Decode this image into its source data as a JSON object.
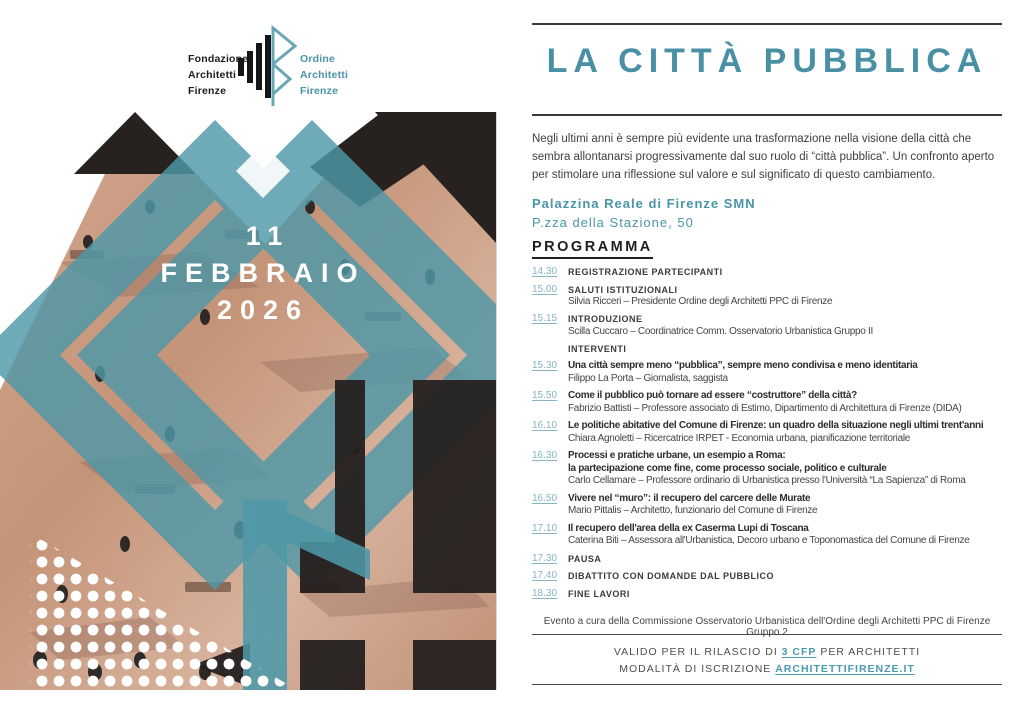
{
  "logos": {
    "fondazione": "Fondazione\nArchitetti\nFirenze",
    "ordine": "Ordine\nArchitetti\nFirenze"
  },
  "poster": {
    "date_line1": "11",
    "date_line2": "FEBBRAIO",
    "date_line3": "2026"
  },
  "header": {
    "title": "LA CITTÀ PUBBLICA"
  },
  "intro": "Negli ultimi anni è sempre più evidente una trasformazione nella visione della città che sembra allontanarsi progressivamente dal suo ruolo di “città pubblica”. Un confronto aperto per stimolare una riflessione sul valore e sul significato di questo cambiamento.",
  "venue": {
    "name": "Palazzina Reale di Firenze SMN",
    "address": "P.zza della Stazione, 50"
  },
  "program": {
    "heading": "PROGRAMMA",
    "items": [
      {
        "time": "14.30",
        "title": "REGISTRAZIONE PARTECIPANTI"
      },
      {
        "time": "15.00",
        "title": "SALUTI ISTITUZIONALI",
        "speaker": "Silvia Ricceri – Presidente Ordine degli Architetti PPC di Firenze"
      },
      {
        "time": "15.15",
        "title": "INTRODUZIONE",
        "speaker": "Scilla Cuccaro – Coordinatrice Comm. Osservatorio Urbanistica Gruppo II"
      },
      {
        "time": "",
        "title": "INTERVENTI"
      },
      {
        "time": "15.30",
        "title": "Una città sempre meno “pubblica”, sempre meno condivisa e meno identitaria",
        "speaker": "Filippo La Porta – Giornalista, saggista"
      },
      {
        "time": "15.50",
        "title": "Come il pubblico può tornare ad essere “costruttore” della città?",
        "speaker": "Fabrizio Battisti – Professore associato di Estimo, Dipartimento di Architettura di Firenze (DIDA)"
      },
      {
        "time": "16.10",
        "title": "Le politiche abitative del Comune di Firenze: un quadro della situazione negli ultimi trent'anni",
        "speaker": "Chiara Agnoletti – Ricercatrice IRPET - Economia urbana, pianificazione territoriale"
      },
      {
        "time": "16.30",
        "title": "Processi e pratiche urbane, un esempio a Roma:",
        "title2": "la partecipazione come fine, come processo sociale, politico e culturale",
        "speaker": "Carlo Cellamare – Professore ordinario di Urbanistica presso l'Università “La Sapienza” di Roma"
      },
      {
        "time": "16.50",
        "title": "Vivere nel “muro”: il recupero del carcere delle Murate",
        "speaker": "Mario Pittalis – Architetto, funzionario del Comune di Firenze"
      },
      {
        "time": "17.10",
        "title": "Il recupero dell'area della ex Caserma Lupi di Toscana",
        "speaker": "Caterina Biti – Assessora all'Urbanistica, Decoro urbano e Toponomastica del Comune di Firenze"
      },
      {
        "time": "17.30",
        "title": "PAUSA"
      },
      {
        "time": "17.40",
        "title": "DIBATTITO CON DOMANDE DAL PUBBLICO"
      },
      {
        "time": "18.30",
        "title": "FINE LAVORI"
      }
    ]
  },
  "footer": {
    "credit": "Evento a cura della Commissione Osservatorio Urbanistica dell'Ordine degli Architetti PPC di Firenze Gruppo 2",
    "cfp_pre": "VALIDO PER IL RILASCIO DI ",
    "cfp_link": "3 CFP",
    "cfp_post": " PER ARCHITETTI",
    "reg_pre": "MODALITÀ DI ISCRIZIONE ",
    "reg_link": "ARCHITETTIFIRENZE.IT"
  },
  "colors": {
    "accent_teal": "#4a90a4",
    "overlay_teal": "#4f98a8",
    "time_teal": "#85b5c3",
    "dark_collage": "#272120",
    "pavement_tan": "#c79a86"
  }
}
